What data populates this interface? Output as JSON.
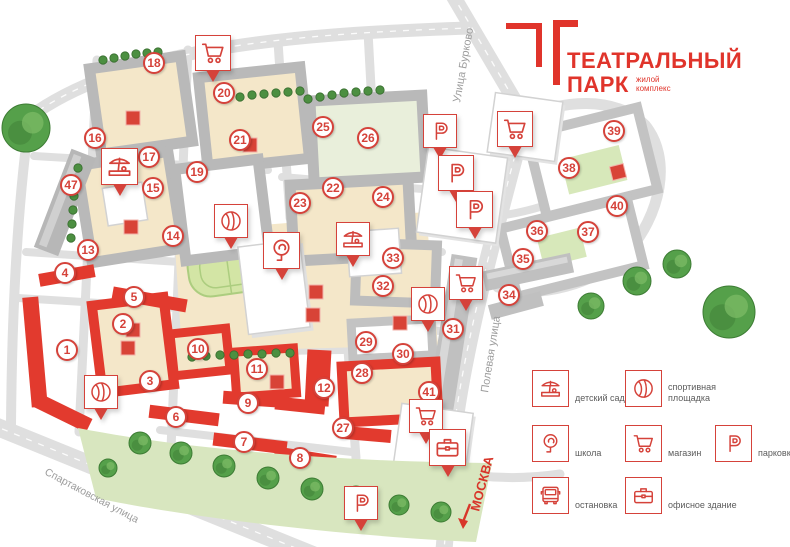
{
  "logo": {
    "title": "ТЕАТРАЛЬНЫЙ",
    "title2": "ПАРК",
    "subtitle": "жилой\nкомплекс"
  },
  "streets": {
    "burkovo": "Улица Бурково",
    "polevaya": "Полевая улица",
    "spartakovskaya": "Спартаковская улица",
    "moscow": "МОСКВА"
  },
  "colors": {
    "brand": "#e0342b",
    "marker": "#d5423a",
    "building_red": "#e23a2e"
  },
  "map": {
    "units": [
      {
        "n": 1,
        "x": 67,
        "y": 350
      },
      {
        "n": 2,
        "x": 123,
        "y": 324
      },
      {
        "n": 3,
        "x": 150,
        "y": 381
      },
      {
        "n": 4,
        "x": 65,
        "y": 273
      },
      {
        "n": 5,
        "x": 134,
        "y": 297
      },
      {
        "n": 6,
        "x": 176,
        "y": 417
      },
      {
        "n": 7,
        "x": 244,
        "y": 442
      },
      {
        "n": 8,
        "x": 300,
        "y": 458
      },
      {
        "n": 9,
        "x": 248,
        "y": 403
      },
      {
        "n": 10,
        "x": 198,
        "y": 349
      },
      {
        "n": 11,
        "x": 257,
        "y": 369
      },
      {
        "n": 12,
        "x": 324,
        "y": 388
      },
      {
        "n": 13,
        "x": 88,
        "y": 250
      },
      {
        "n": 14,
        "x": 173,
        "y": 236
      },
      {
        "n": 15,
        "x": 153,
        "y": 188
      },
      {
        "n": 16,
        "x": 95,
        "y": 138
      },
      {
        "n": 17,
        "x": 149,
        "y": 157
      },
      {
        "n": 18,
        "x": 154,
        "y": 63
      },
      {
        "n": 19,
        "x": 197,
        "y": 172
      },
      {
        "n": 20,
        "x": 224,
        "y": 93
      },
      {
        "n": 21,
        "x": 240,
        "y": 140
      },
      {
        "n": 22,
        "x": 333,
        "y": 188
      },
      {
        "n": 23,
        "x": 300,
        "y": 203
      },
      {
        "n": 24,
        "x": 383,
        "y": 197
      },
      {
        "n": 25,
        "x": 323,
        "y": 127
      },
      {
        "n": 26,
        "x": 368,
        "y": 138
      },
      {
        "n": 27,
        "x": 343,
        "y": 428
      },
      {
        "n": 28,
        "x": 362,
        "y": 373
      },
      {
        "n": 29,
        "x": 366,
        "y": 342
      },
      {
        "n": 30,
        "x": 403,
        "y": 354
      },
      {
        "n": 31,
        "x": 453,
        "y": 329
      },
      {
        "n": 32,
        "x": 383,
        "y": 286
      },
      {
        "n": 33,
        "x": 393,
        "y": 258
      },
      {
        "n": 34,
        "x": 509,
        "y": 295
      },
      {
        "n": 35,
        "x": 523,
        "y": 259
      },
      {
        "n": 36,
        "x": 537,
        "y": 231
      },
      {
        "n": 37,
        "x": 588,
        "y": 232
      },
      {
        "n": 38,
        "x": 569,
        "y": 168
      },
      {
        "n": 39,
        "x": 614,
        "y": 131
      },
      {
        "n": 40,
        "x": 617,
        "y": 206
      },
      {
        "n": 41,
        "x": 429,
        "y": 392
      },
      {
        "n": 47,
        "x": 71,
        "y": 185
      }
    ],
    "pins": [
      {
        "icon": "parking-icon",
        "x": 423,
        "y": 114,
        "s": 34
      },
      {
        "icon": "parking-icon",
        "x": 438,
        "y": 155,
        "s": 36
      },
      {
        "icon": "parking-icon",
        "x": 456,
        "y": 191,
        "s": 37
      },
      {
        "icon": "shop-cart-icon",
        "x": 497,
        "y": 111,
        "s": 36
      },
      {
        "icon": "shop-cart-icon",
        "x": 195,
        "y": 35,
        "s": 36
      },
      {
        "icon": "kindergarten-icon",
        "x": 101,
        "y": 148,
        "s": 37
      },
      {
        "icon": "sport-icon",
        "x": 214,
        "y": 204,
        "s": 34
      },
      {
        "icon": "school-icon",
        "x": 263,
        "y": 232,
        "s": 37
      },
      {
        "icon": "kindergarten-icon",
        "x": 336,
        "y": 222,
        "s": 34
      },
      {
        "icon": "sport-icon",
        "x": 411,
        "y": 287,
        "s": 34
      },
      {
        "icon": "sport-icon",
        "x": 84,
        "y": 375,
        "s": 34
      },
      {
        "icon": "shop-cart-icon",
        "x": 449,
        "y": 266,
        "s": 34
      },
      {
        "icon": "shop-cart-icon",
        "x": 409,
        "y": 399,
        "s": 34
      },
      {
        "icon": "office-icon",
        "x": 429,
        "y": 429,
        "s": 37
      },
      {
        "icon": "parking-icon",
        "x": 344,
        "y": 486,
        "s": 34
      }
    ]
  },
  "legend": {
    "items": [
      {
        "icon": "kindergarten-icon",
        "label": "детский сад",
        "x": 532,
        "y": 370
      },
      {
        "icon": "sport-icon",
        "label": "спортивная\nплощадка",
        "x": 625,
        "y": 370
      },
      {
        "icon": "school-icon",
        "label": "школа",
        "x": 532,
        "y": 425
      },
      {
        "icon": "shop-cart-icon",
        "label": "магазин",
        "x": 625,
        "y": 425
      },
      {
        "icon": "parking-icon",
        "label": "парковка",
        "x": 715,
        "y": 425
      },
      {
        "icon": "bus-icon",
        "label": "остановка",
        "x": 532,
        "y": 477
      },
      {
        "icon": "office-icon",
        "label": "офисное здание",
        "x": 625,
        "y": 477
      }
    ]
  }
}
